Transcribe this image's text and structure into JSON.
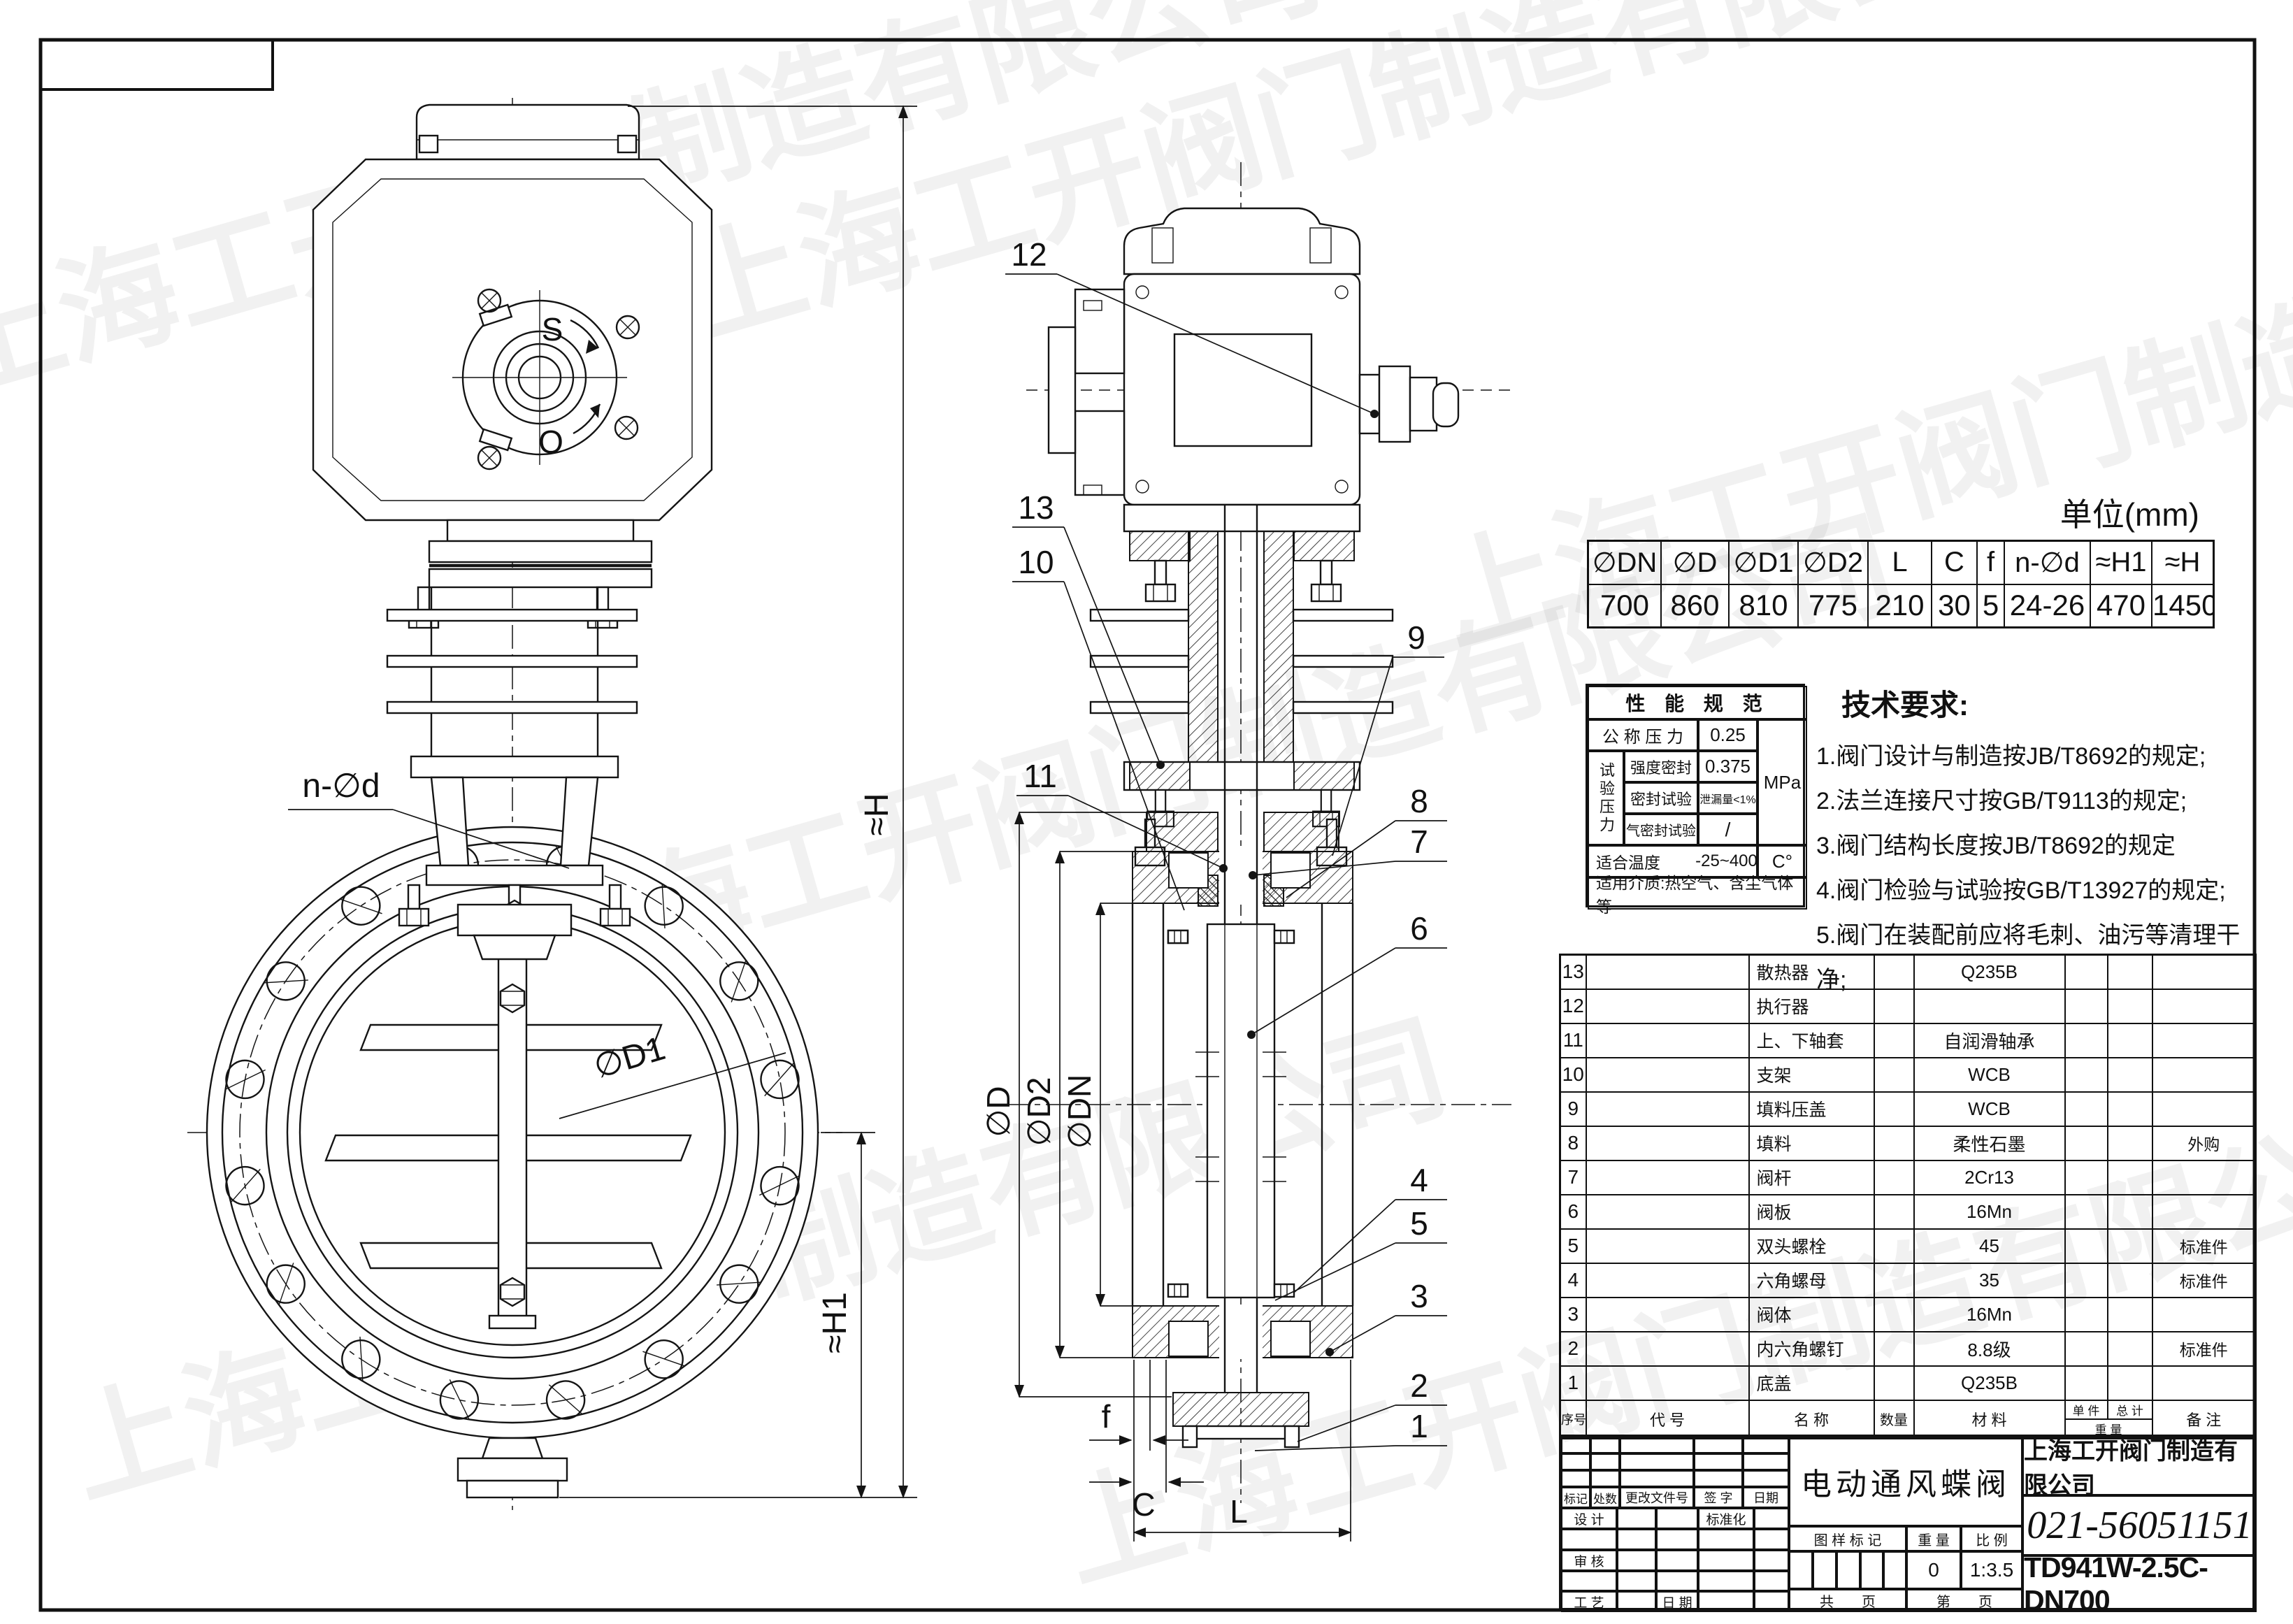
{
  "sheet": {
    "unit_label": "单位(mm)",
    "watermark": "上海工开阀门制造有限公司"
  },
  "dim_table": {
    "headers": [
      "∅DN",
      "∅D",
      "∅D1",
      "∅D2",
      "L",
      "C",
      "f",
      "n-∅d",
      "≈H1",
      "≈H"
    ],
    "values": [
      "700",
      "860",
      "810",
      "775",
      "210",
      "30",
      "5",
      "24-26",
      "470",
      "1450"
    ]
  },
  "performance": {
    "title": "性 能 规 范",
    "nominal_pressure_label": "公 称 压 力",
    "nominal_pressure": "0.25",
    "test_pressure_label": "试验压力",
    "strength_label": "强度密封",
    "strength_value": "0.375",
    "seal_label": "密封试验",
    "seal_value": "泄漏量<1%",
    "air_label": "气密封试验",
    "air_value": "/",
    "pressure_unit": "MPa",
    "temp_label": "适合温度",
    "temp_value": "-25~400",
    "temp_unit": "C°",
    "medium": "适用介质:热空气、含尘气体等"
  },
  "tech_requirements": {
    "title": "技术要求:",
    "items": [
      "1.阀门设计与制造按JB/T8692的规定;",
      "2.法兰连接尺寸按GB/T9113的规定;",
      "3.阀门结构长度按JB/T8692的规定",
      "4.阀门检验与试验按GB/T13927的规定;",
      "5.阀门在装配前应将毛刺、油污等清理干净;"
    ]
  },
  "bom": {
    "headers": {
      "seq": "序号",
      "code": "代    号",
      "name": "名    称",
      "qty": "数量",
      "material": "材    料",
      "unit": "单 件",
      "total": "总 计",
      "weight": "重    量",
      "note": "备    注"
    },
    "rows": [
      {
        "seq": "13",
        "name": "散热器",
        "material": "Q235B",
        "note": ""
      },
      {
        "seq": "12",
        "name": "执行器",
        "material": "",
        "note": ""
      },
      {
        "seq": "11",
        "name": "上、下轴套",
        "material": "自润滑轴承",
        "note": ""
      },
      {
        "seq": "10",
        "name": "支架",
        "material": "WCB",
        "note": ""
      },
      {
        "seq": "9",
        "name": "填料压盖",
        "material": "WCB",
        "note": ""
      },
      {
        "seq": "8",
        "name": "填料",
        "material": "柔性石墨",
        "note": "外购"
      },
      {
        "seq": "7",
        "name": "阀杆",
        "material": "2Cr13",
        "note": ""
      },
      {
        "seq": "6",
        "name": "阀板",
        "material": "16Mn",
        "note": ""
      },
      {
        "seq": "5",
        "name": "双头螺栓",
        "material": "45",
        "note": "标准件"
      },
      {
        "seq": "4",
        "name": "六角螺母",
        "material": "35",
        "note": "标准件"
      },
      {
        "seq": "3",
        "name": "阀体",
        "material": "16Mn",
        "note": ""
      },
      {
        "seq": "2",
        "name": "内六角螺钉",
        "material": "8.8级",
        "note": "标准件"
      },
      {
        "seq": "1",
        "name": "底盖",
        "material": "Q235B",
        "note": ""
      }
    ]
  },
  "title_block": {
    "product_name": "电动通风蝶阀",
    "company": "上海工开阀门制造有限公司",
    "phone": "021-56051151",
    "model": "TD941W-2.5C-DN700",
    "weight_value": "0",
    "scale_value": "1:3.5",
    "labels": {
      "mark": "标记",
      "count": "处数",
      "change_doc": "更改文件号",
      "sign": "签 字",
      "date": "日期",
      "design": "设 计",
      "standardize": "标准化",
      "check": "审 核",
      "craft": "工 艺",
      "date2": "日 期",
      "drawing_mark": "图 样 标 记",
      "weight": "重 量",
      "scale": "比 例",
      "pages_total": "共　　页",
      "page_no": "第　　页"
    }
  },
  "callouts": {
    "c1": "1",
    "c2": "2",
    "c3": "3",
    "c4": "4",
    "c5": "5",
    "c6": "6",
    "c7": "7",
    "c8": "8",
    "c9": "9",
    "c10": "10",
    "c11": "11",
    "c12": "12",
    "c13": "13"
  },
  "dims": {
    "n_d": "n-∅d",
    "d1": "∅D1",
    "h1": "≈H1",
    "h": "≈H",
    "D": "∅D",
    "D2": "∅D2",
    "DN": "∅DN",
    "f": "f",
    "C": "C",
    "L": "L"
  },
  "actuator": {
    "open_mark": "S",
    "close_mark": "O"
  }
}
